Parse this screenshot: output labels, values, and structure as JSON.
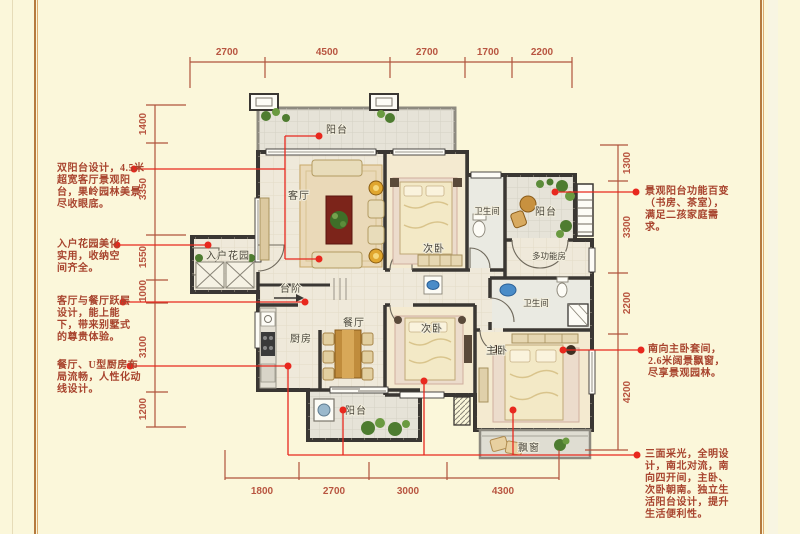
{
  "colors": {
    "background": "#fbf7da",
    "wall": "#3a3733",
    "dimension": "#b85540",
    "leader": "#e8281e",
    "annotation_text": "#a8442e"
  },
  "rooms": {
    "balcony_top": "阳台",
    "living": "客厅",
    "bedroom_top": "次卧",
    "bath_top": "卫生间",
    "balcony_right": "阳台",
    "multi_room": "多功能房",
    "entry_garden": "入户花园",
    "steps": "台阶",
    "kitchen": "厨房",
    "dining": "餐厅",
    "bath_bottom": "卫生间",
    "bedroom_bottom": "次卧",
    "master": "主卧",
    "balcony_bottom": "阳台",
    "bay_window": "飘窗"
  },
  "dims": {
    "top": [
      "2700",
      "4500",
      "2700",
      "1700",
      "2200"
    ],
    "bottom": [
      "1800",
      "2700",
      "3000",
      "4300"
    ],
    "left": [
      "1400",
      "3350",
      "1550",
      "1000",
      "3100",
      "1200"
    ],
    "right": [
      "1300",
      "3300",
      "2200",
      "4200"
    ]
  },
  "annotations": {
    "left": [
      "双阳台设计，4.5米超宽客厅景观阳台，果岭园林美景尽收眼底。",
      "入户花园美化实用，收纳空间齐全。",
      "客厅与餐厅跃层设计，能上能下，带来别墅式的尊贵体验。",
      "餐厅、U型厨房布局流畅，人性化动线设计。"
    ],
    "right": [
      "景观阳台功能百变（书房、茶室），满足二孩家庭需求。",
      "南向主卧套间，2.6米阔景飘窗，尽享景观园林。",
      "三面采光，全明设计，南北对流，南向四开间，主卧、次卧朝南。独立生活阳台设计，提升生活便利性。"
    ]
  }
}
